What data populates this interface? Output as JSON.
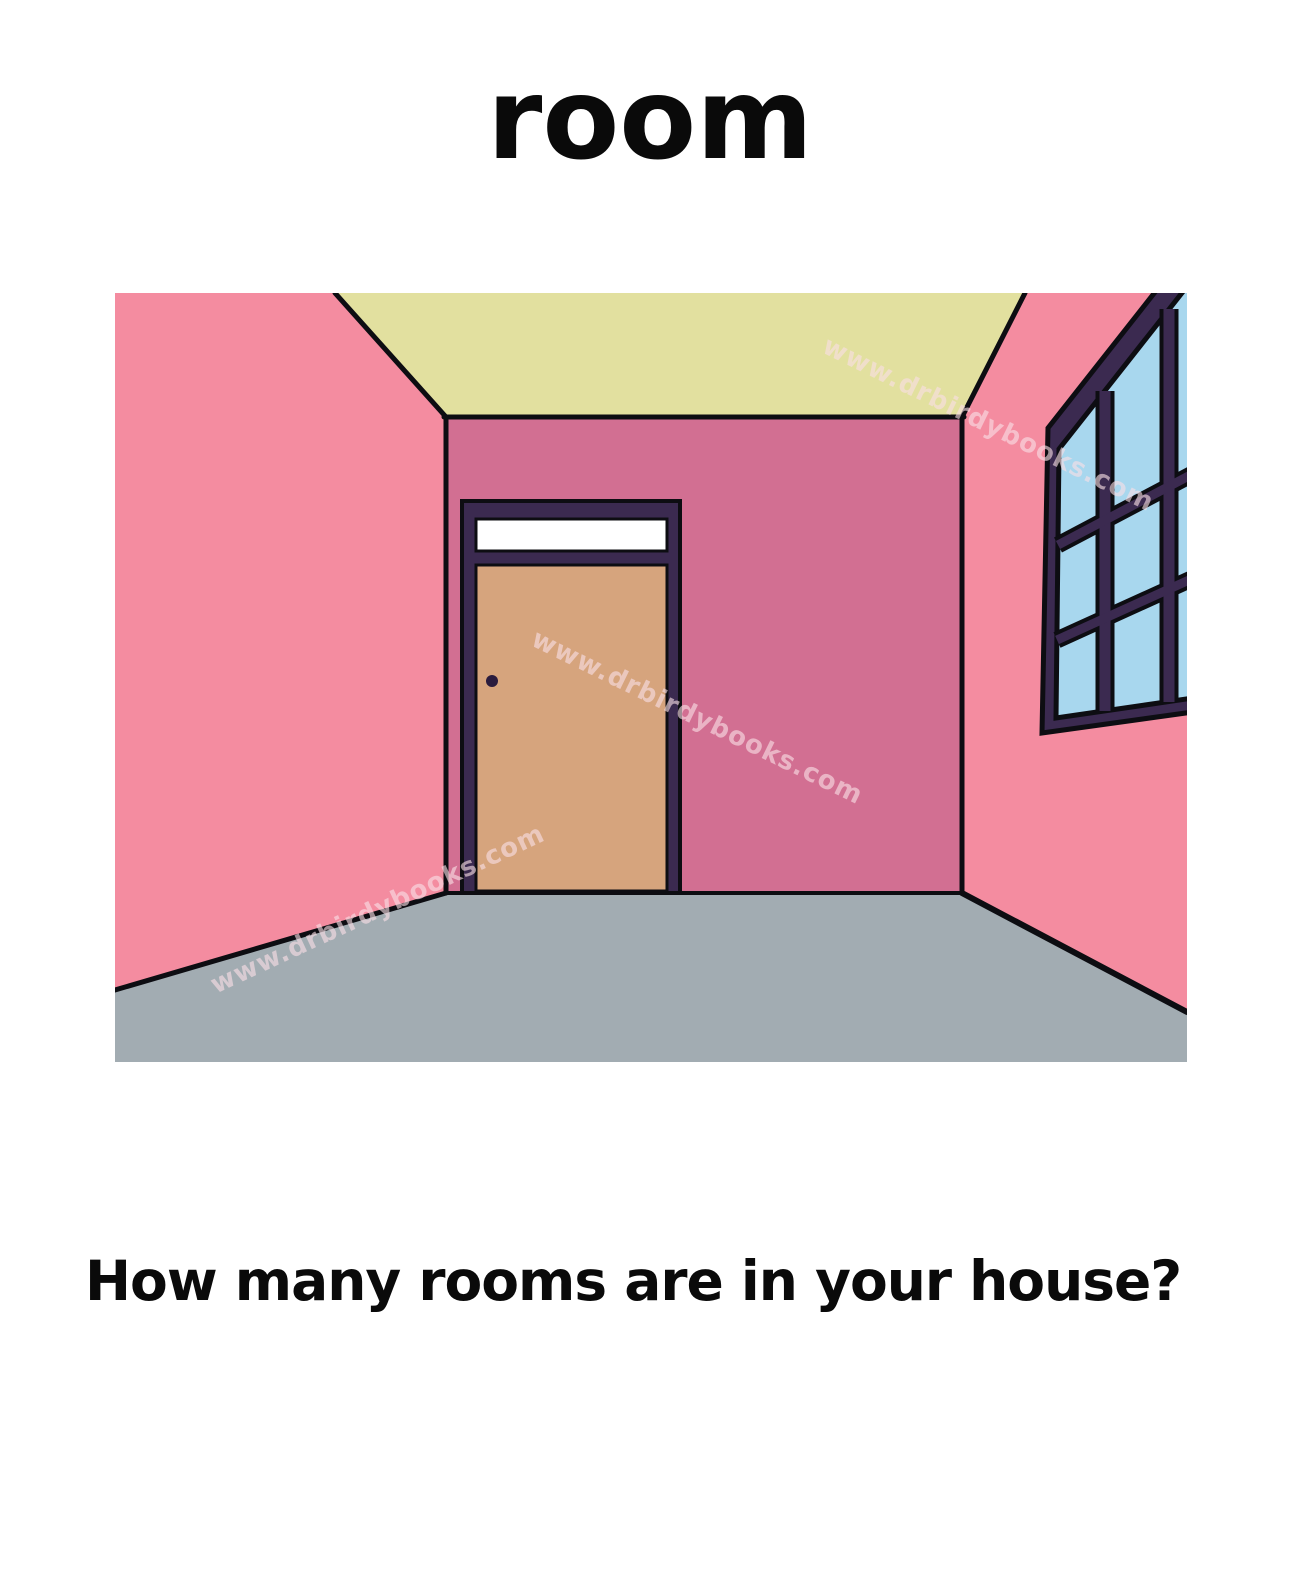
{
  "page": {
    "title": "room",
    "question": "How many rooms are in your house?"
  },
  "watermark": {
    "text": "www.drbirdybooks.com",
    "color": "rgba(248,222,229,0.62)"
  },
  "illustration": {
    "subject": "empty room interior with closed door and window",
    "colors": {
      "side_walls": "#F48CA0",
      "back_wall": "#D26F92",
      "ceiling": "#E2E09F",
      "floor": "#A2ACB2",
      "frame_purple": "#3B2A50",
      "door": "#D6A47D",
      "door_knob": "#2A1B3D",
      "window_glass": "#A8D7EE",
      "transom": "#FFFFFF",
      "outline": "#0D0D12"
    }
  }
}
